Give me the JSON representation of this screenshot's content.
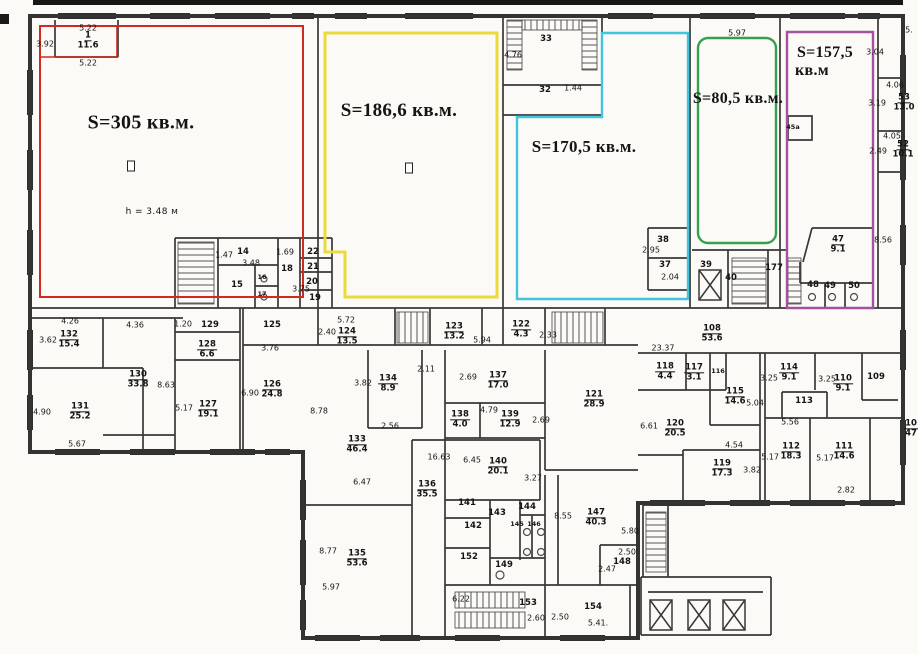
{
  "plan": {
    "units": "кв.м",
    "note": "h = 3.48 м"
  },
  "zones": [
    {
      "name": "zone-red",
      "label": "S=305 кв.м.",
      "color": "#cf2a21",
      "x": 141,
      "y": 123,
      "fs": 20
    },
    {
      "name": "zone-yellow",
      "label": "S=186,6 кв.м.",
      "color": "#ecd93b",
      "x": 399,
      "y": 111,
      "fs": 19
    },
    {
      "name": "zone-cyan",
      "label": "S=170,5 кв.м.",
      "color": "#42c4de",
      "x": 584,
      "y": 147,
      "fs": 17
    },
    {
      "name": "zone-green",
      "label": "S=80,5 кв.м.",
      "color": "#33a14f",
      "x": 738,
      "y": 99,
      "fs": 16
    },
    {
      "name": "zone-purple",
      "label": "S=157,5",
      "color": "#a4519f",
      "x": 825,
      "y": 53,
      "fs": 16,
      "sub": "кв.м",
      "sx": 812,
      "sy": 71
    }
  ],
  "rooms": [
    {
      "n": "1",
      "a": "11.6",
      "x": 88,
      "y": 41
    },
    {
      "n": "132",
      "a": "15.4",
      "x": 69,
      "y": 340
    },
    {
      "n": "130",
      "a": "33.8",
      "x": 138,
      "y": 380
    },
    {
      "n": "131",
      "a": "25.2",
      "x": 80,
      "y": 412
    },
    {
      "n": "128",
      "a": "6.6",
      "x": 207,
      "y": 350
    },
    {
      "n": "127",
      "a": "19.1",
      "x": 208,
      "y": 410
    },
    {
      "n": "126",
      "a": "24.8",
      "x": 272,
      "y": 390
    },
    {
      "n": "124",
      "a": "13.5",
      "x": 347,
      "y": 337
    },
    {
      "n": "123",
      "a": "13.2",
      "x": 454,
      "y": 332
    },
    {
      "n": "122",
      "a": "4.3",
      "x": 521,
      "y": 330
    },
    {
      "n": "134",
      "a": "8.9",
      "x": 388,
      "y": 384
    },
    {
      "n": "133",
      "a": "46.4",
      "x": 357,
      "y": 445
    },
    {
      "n": "137",
      "a": "17.0",
      "x": 498,
      "y": 381
    },
    {
      "n": "138",
      "a": "4.0",
      "x": 460,
      "y": 420
    },
    {
      "n": "139",
      "a": "12.9",
      "x": 510,
      "y": 420
    },
    {
      "n": "121",
      "a": "28.9",
      "x": 594,
      "y": 400
    },
    {
      "n": "136",
      "a": "35.5",
      "x": 427,
      "y": 490
    },
    {
      "n": "140",
      "a": "20.1",
      "x": 498,
      "y": 467
    },
    {
      "n": "135",
      "a": "53.6",
      "x": 357,
      "y": 559
    },
    {
      "n": "147",
      "a": "40.3",
      "x": 596,
      "y": 518
    },
    {
      "n": "108",
      "a": "53.6",
      "x": 712,
      "y": 334
    },
    {
      "n": "118",
      "a": "4.4",
      "x": 665,
      "y": 372
    },
    {
      "n": "117",
      "a": "3.1",
      "x": 694,
      "y": 373
    },
    {
      "n": "115",
      "a": "14.6",
      "x": 735,
      "y": 397
    },
    {
      "n": "120",
      "a": "20.5",
      "x": 675,
      "y": 429
    },
    {
      "n": "119",
      "a": "17.3",
      "x": 722,
      "y": 469
    },
    {
      "n": "114",
      "a": "9.1",
      "x": 789,
      "y": 373
    },
    {
      "n": "110",
      "a": "9.1",
      "x": 843,
      "y": 384
    },
    {
      "n": "112",
      "a": "18.3",
      "x": 791,
      "y": 452
    },
    {
      "n": "111",
      "a": "14.6",
      "x": 844,
      "y": 452
    },
    {
      "n": "47",
      "a": "9.1",
      "x": 838,
      "y": 245
    },
    {
      "n": "53",
      "a": "13.0",
      "x": 904,
      "y": 103
    },
    {
      "n": "52",
      "a": "10.1",
      "x": 903,
      "y": 150
    },
    {
      "n": "10",
      "a": "47",
      "x": 911,
      "y": 429
    }
  ],
  "nums": [
    {
      "t": "33",
      "x": 546,
      "y": 39
    },
    {
      "t": "32",
      "x": 545,
      "y": 90
    },
    {
      "t": "14",
      "x": 243,
      "y": 252
    },
    {
      "t": "15",
      "x": 237,
      "y": 285
    },
    {
      "t": "16",
      "x": 262,
      "y": 277,
      "s": 1
    },
    {
      "t": "17",
      "x": 262,
      "y": 294,
      "s": 1
    },
    {
      "t": "18",
      "x": 287,
      "y": 269
    },
    {
      "t": "19",
      "x": 315,
      "y": 298
    },
    {
      "t": "20",
      "x": 312,
      "y": 282
    },
    {
      "t": "21",
      "x": 313,
      "y": 267
    },
    {
      "t": "22",
      "x": 313,
      "y": 252
    },
    {
      "t": "38",
      "x": 663,
      "y": 240
    },
    {
      "t": "37",
      "x": 665,
      "y": 265
    },
    {
      "t": "39",
      "x": 706,
      "y": 265
    },
    {
      "t": "40",
      "x": 731,
      "y": 278
    },
    {
      "t": "177",
      "x": 774,
      "y": 268
    },
    {
      "t": "45а",
      "x": 793,
      "y": 127,
      "s": 1
    },
    {
      "t": "48",
      "x": 813,
      "y": 285
    },
    {
      "t": "49",
      "x": 830,
      "y": 286
    },
    {
      "t": "50",
      "x": 854,
      "y": 286
    },
    {
      "t": "129",
      "x": 210,
      "y": 325
    },
    {
      "t": "125",
      "x": 272,
      "y": 325
    },
    {
      "t": "141",
      "x": 467,
      "y": 503
    },
    {
      "t": "142",
      "x": 473,
      "y": 526
    },
    {
      "t": "143",
      "x": 497,
      "y": 513
    },
    {
      "t": "144",
      "x": 527,
      "y": 507
    },
    {
      "t": "145",
      "x": 517,
      "y": 524,
      "s": 1
    },
    {
      "t": "146",
      "x": 534,
      "y": 524,
      "s": 1
    },
    {
      "t": "152",
      "x": 469,
      "y": 557
    },
    {
      "t": "149",
      "x": 504,
      "y": 565
    },
    {
      "t": "153",
      "x": 528,
      "y": 603
    },
    {
      "t": "154",
      "x": 593,
      "y": 607
    },
    {
      "t": "148",
      "x": 622,
      "y": 562
    },
    {
      "t": "109",
      "x": 876,
      "y": 377
    },
    {
      "t": "113",
      "x": 804,
      "y": 401
    },
    {
      "t": "116",
      "x": 718,
      "y": 371,
      "s": 1,
      "v": 1
    }
  ],
  "dims": [
    {
      "t": "5.22",
      "x": 88,
      "y": 28
    },
    {
      "t": "5.22",
      "x": 88,
      "y": 63
    },
    {
      "t": "3.92",
      "x": 45,
      "y": 44,
      "v": 1
    },
    {
      "t": "4.76",
      "x": 513,
      "y": 55,
      "v": 1
    },
    {
      "t": "1.44",
      "x": 573,
      "y": 88,
      "v": 1
    },
    {
      "t": "5.97",
      "x": 737,
      "y": 33
    },
    {
      "t": "3.04",
      "x": 875,
      "y": 52,
      "v": 1
    },
    {
      "t": "5.",
      "x": 909,
      "y": 30
    },
    {
      "t": "4.06",
      "x": 895,
      "y": 85
    },
    {
      "t": "3.19",
      "x": 877,
      "y": 103,
      "v": 1
    },
    {
      "t": "4.05",
      "x": 892,
      "y": 136
    },
    {
      "t": "2.49",
      "x": 878,
      "y": 151,
      "v": 1
    },
    {
      "t": "8.56",
      "x": 883,
      "y": 240,
      "v": 1
    },
    {
      "t": "h = 3.48 м",
      "x": 152,
      "y": 212,
      "s": "note"
    },
    {
      "t": "1.47",
      "x": 224,
      "y": 255,
      "v": 1
    },
    {
      "t": "3.48",
      "x": 251,
      "y": 263
    },
    {
      "t": "1.69",
      "x": 285,
      "y": 252
    },
    {
      "t": "3.75",
      "x": 301,
      "y": 289,
      "v": 1
    },
    {
      "t": "2.95",
      "x": 651,
      "y": 250,
      "v": 1
    },
    {
      "t": "2.04",
      "x": 670,
      "y": 277
    },
    {
      "t": "4.26",
      "x": 70,
      "y": 321
    },
    {
      "t": "3.62",
      "x": 48,
      "y": 340,
      "v": 1
    },
    {
      "t": "4.36",
      "x": 135,
      "y": 325
    },
    {
      "t": "1.20",
      "x": 183,
      "y": 324,
      "v": 1
    },
    {
      "t": "8.63",
      "x": 166,
      "y": 385,
      "v": 1
    },
    {
      "t": "5.17",
      "x": 184,
      "y": 408,
      "v": 1
    },
    {
      "t": "4.90",
      "x": 42,
      "y": 412,
      "v": 1
    },
    {
      "t": "5.67",
      "x": 77,
      "y": 444
    },
    {
      "t": "3.76",
      "x": 270,
      "y": 348
    },
    {
      "t": "6.90",
      "x": 250,
      "y": 393,
      "v": 1
    },
    {
      "t": "5.72",
      "x": 346,
      "y": 320
    },
    {
      "t": "2.40",
      "x": 327,
      "y": 332,
      "v": 1
    },
    {
      "t": "5.94",
      "x": 482,
      "y": 340
    },
    {
      "t": "2.33",
      "x": 548,
      "y": 335,
      "v": 1
    },
    {
      "t": "23.37",
      "x": 663,
      "y": 348
    },
    {
      "t": "2.11",
      "x": 426,
      "y": 369
    },
    {
      "t": "3.82",
      "x": 363,
      "y": 383,
      "v": 1
    },
    {
      "t": "2.56",
      "x": 390,
      "y": 426
    },
    {
      "t": "8.78",
      "x": 319,
      "y": 411,
      "v": 1
    },
    {
      "t": "2.69",
      "x": 468,
      "y": 377,
      "v": 1
    },
    {
      "t": "4.79",
      "x": 489,
      "y": 410
    },
    {
      "t": "2.69",
      "x": 541,
      "y": 420,
      "v": 1
    },
    {
      "t": "6.47",
      "x": 362,
      "y": 482
    },
    {
      "t": "8.77",
      "x": 328,
      "y": 551,
      "v": 1
    },
    {
      "t": "5.97",
      "x": 331,
      "y": 587
    },
    {
      "t": "16.63",
      "x": 439,
      "y": 457,
      "v": 1
    },
    {
      "t": "6.45",
      "x": 472,
      "y": 460
    },
    {
      "t": "3.27",
      "x": 533,
      "y": 478,
      "v": 1
    },
    {
      "t": "8.55",
      "x": 563,
      "y": 516,
      "v": 1
    },
    {
      "t": "6.22",
      "x": 461,
      "y": 599
    },
    {
      "t": "2.60",
      "x": 536,
      "y": 618,
      "v": 1
    },
    {
      "t": "2.50",
      "x": 560,
      "y": 617,
      "v": 1
    },
    {
      "t": "5.41.",
      "x": 598,
      "y": 623
    },
    {
      "t": "5.80",
      "x": 630,
      "y": 531
    },
    {
      "t": "2.50",
      "x": 627,
      "y": 552
    },
    {
      "t": "2.47",
      "x": 607,
      "y": 569,
      "v": 1
    },
    {
      "t": "6.61",
      "x": 649,
      "y": 426,
      "v": 1
    },
    {
      "t": "5.04",
      "x": 755,
      "y": 403,
      "v": 1
    },
    {
      "t": "4.54",
      "x": 734,
      "y": 445
    },
    {
      "t": "3.82",
      "x": 752,
      "y": 470,
      "v": 1
    },
    {
      "t": "3.25",
      "x": 769,
      "y": 378,
      "v": 1
    },
    {
      "t": "3.25",
      "x": 827,
      "y": 379,
      "v": 1
    },
    {
      "t": "5.56",
      "x": 790,
      "y": 422
    },
    {
      "t": "5.17",
      "x": 770,
      "y": 457,
      "v": 1
    },
    {
      "t": "5.17",
      "x": 825,
      "y": 458,
      "v": 1
    },
    {
      "t": "2.82",
      "x": 846,
      "y": 490
    }
  ],
  "symbols": [
    {
      "name": "column-icon",
      "x": 131,
      "y": 166
    },
    {
      "name": "column-icon",
      "x": 409,
      "y": 168
    }
  ]
}
